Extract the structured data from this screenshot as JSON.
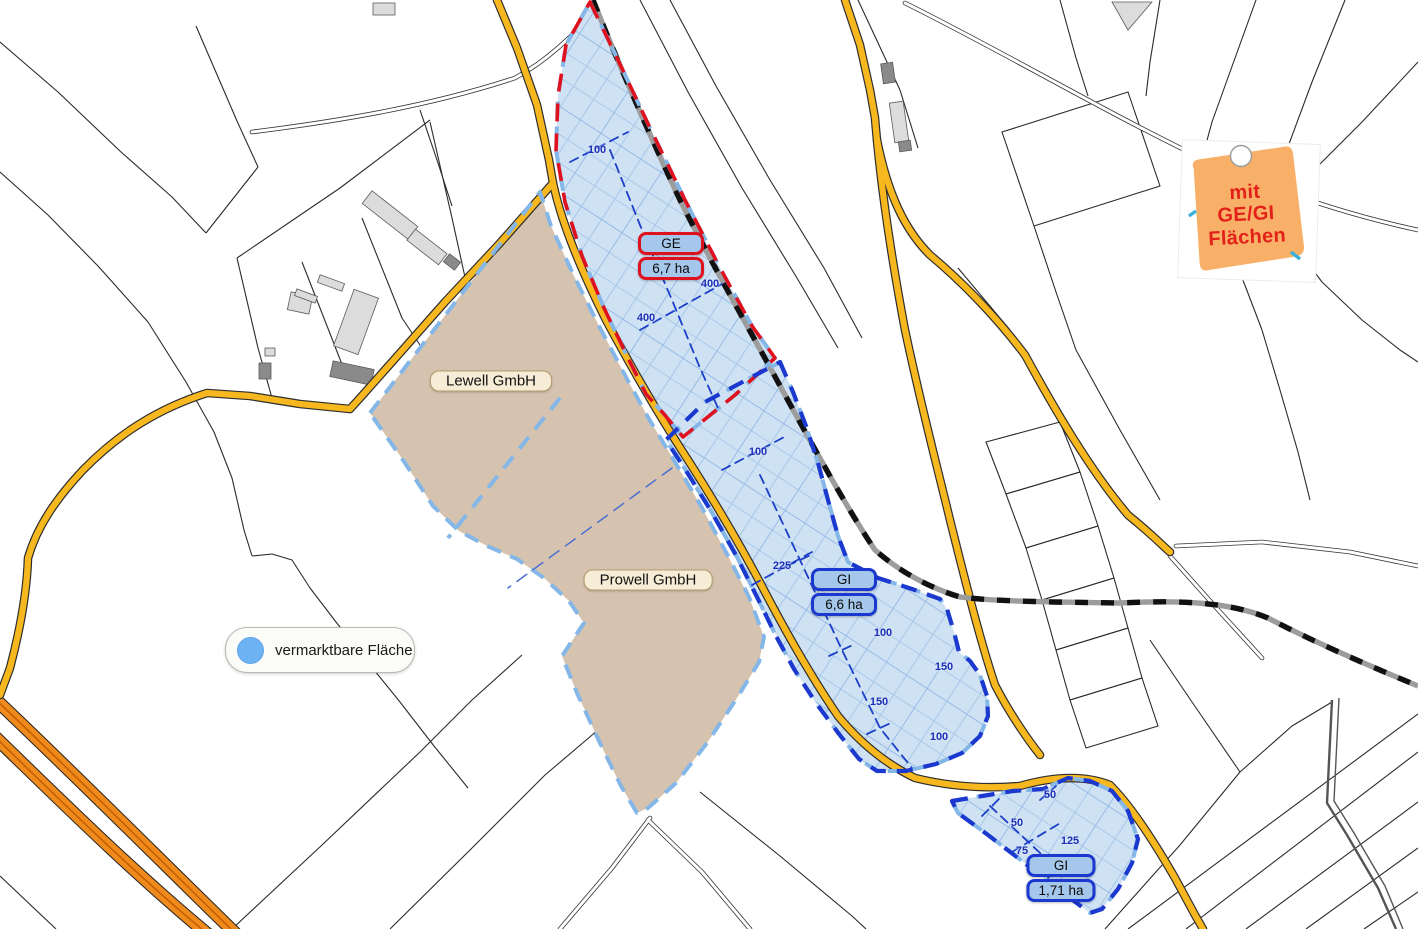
{
  "map": {
    "note": {
      "lines": [
        "mit",
        "GE/GI",
        "Flächen"
      ],
      "fill_color": "#f8b069",
      "text_color": "#e32119"
    },
    "legend": {
      "items": [
        {
          "label": "vermarktbare Fläche",
          "swatch_color": "#6db2f3"
        }
      ]
    },
    "areas": {
      "ge": {
        "code": "GE",
        "size": "6,7 ha",
        "border_color": "#e0111f"
      },
      "gi_main": {
        "code": "GI",
        "size": "6,6 ha",
        "border_color": "#1b38cf"
      },
      "gi_south": {
        "code": "GI",
        "size": "1,71 ha",
        "border_color": "#1b38cf"
      }
    },
    "companies": [
      {
        "name": "Lewell GmbH"
      },
      {
        "name": "Prowell GmbH"
      }
    ],
    "dimensions": [
      {
        "value": "100"
      },
      {
        "value": "400"
      },
      {
        "value": "400"
      },
      {
        "value": "100"
      },
      {
        "value": "225"
      },
      {
        "value": "100"
      },
      {
        "value": "150"
      },
      {
        "value": "150"
      },
      {
        "value": "100"
      },
      {
        "value": "50"
      },
      {
        "value": "50"
      },
      {
        "value": "125"
      },
      {
        "value": "75"
      }
    ],
    "colors": {
      "marketable_fill": "#cfe2f4",
      "marketable_outline": "#84b7e8",
      "company_parcel_fill": "#d5c3af",
      "road_primary": "#f6b81e",
      "highway": "#ef8b1d",
      "ge_border": "#e0111f",
      "gi_border": "#1b38cf"
    }
  }
}
